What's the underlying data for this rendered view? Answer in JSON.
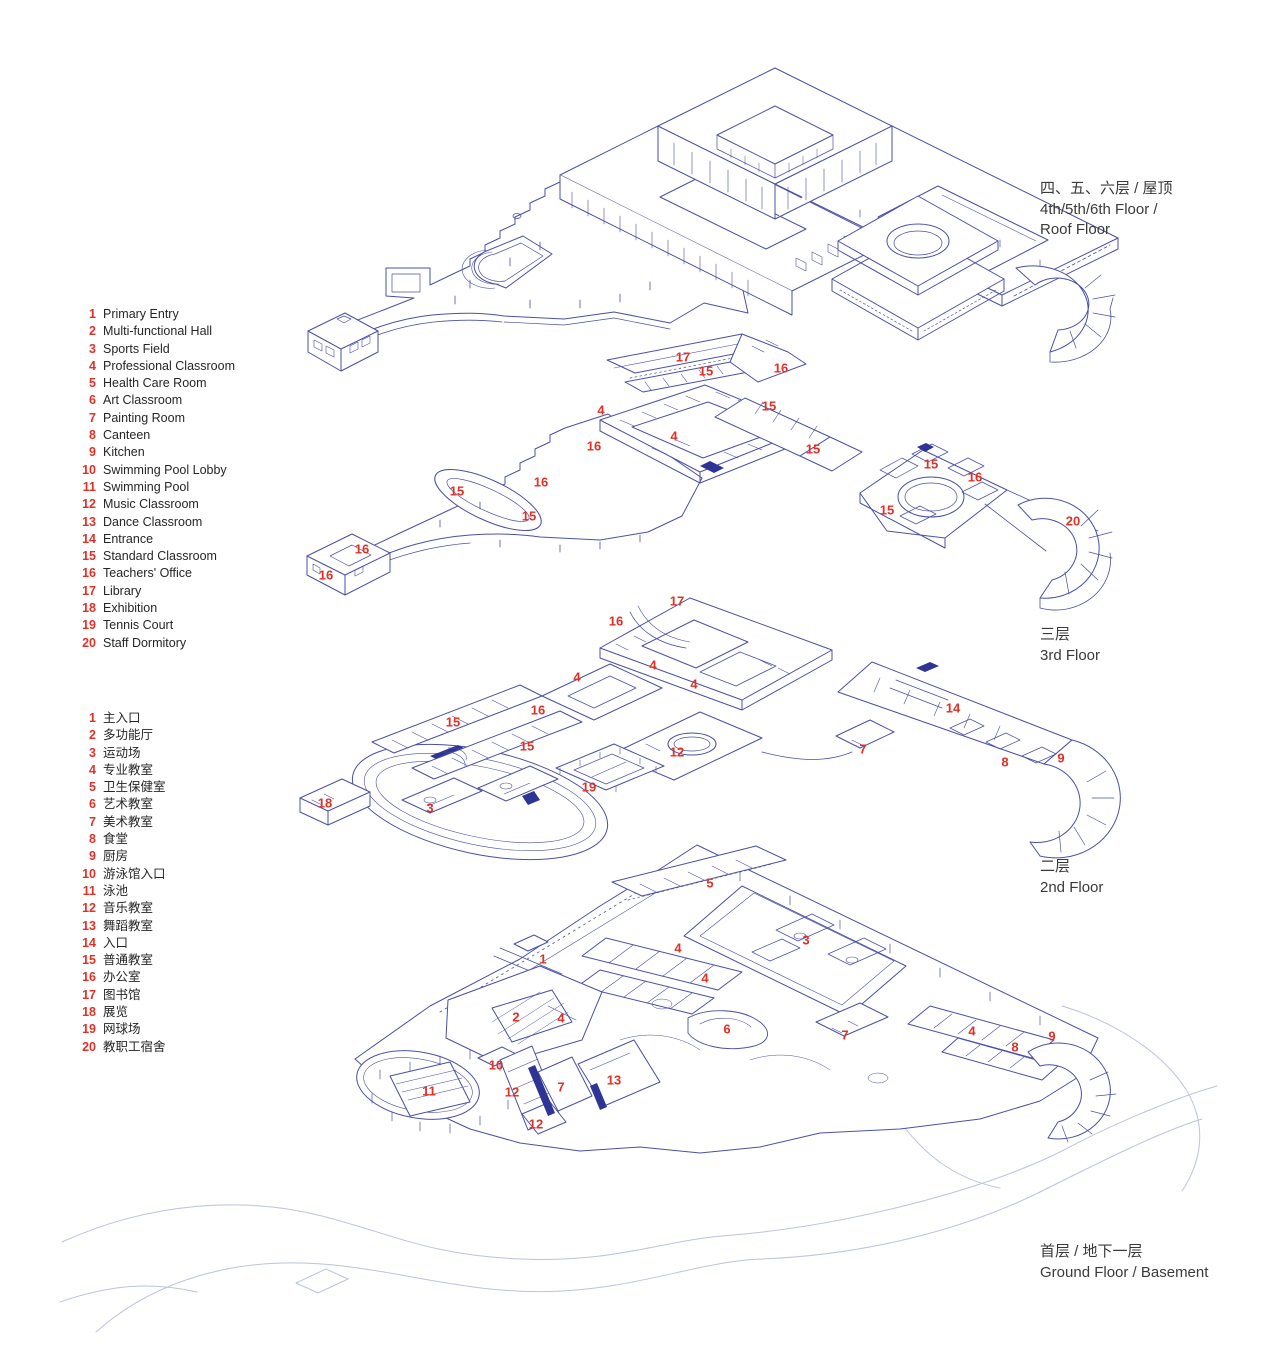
{
  "colors": {
    "ink": "#4a50a5",
    "ink_dark": "#2e3494",
    "site_line": "#bcc4de",
    "red": "#e03127",
    "text": "#262626"
  },
  "legend_en": {
    "items": [
      {
        "num": "1",
        "label": "Primary Entry"
      },
      {
        "num": "2",
        "label": "Multi-functional Hall"
      },
      {
        "num": "3",
        "label": "Sports Field"
      },
      {
        "num": "4",
        "label": "Professional Classroom"
      },
      {
        "num": "5",
        "label": "Health Care Room"
      },
      {
        "num": "6",
        "label": "Art Classroom"
      },
      {
        "num": "7",
        "label": "Painting Room"
      },
      {
        "num": "8",
        "label": "Canteen"
      },
      {
        "num": "9",
        "label": "Kitchen"
      },
      {
        "num": "10",
        "label": "Swimming Pool Lobby"
      },
      {
        "num": "11",
        "label": "Swimming Pool"
      },
      {
        "num": "12",
        "label": "Music Classroom"
      },
      {
        "num": "13",
        "label": "Dance Classroom"
      },
      {
        "num": "14",
        "label": "Entrance"
      },
      {
        "num": "15",
        "label": "Standard Classroom"
      },
      {
        "num": "16",
        "label": "Teachers' Office"
      },
      {
        "num": "17",
        "label": "Library"
      },
      {
        "num": "18",
        "label": "Exhibition"
      },
      {
        "num": "19",
        "label": "Tennis Court"
      },
      {
        "num": "20",
        "label": "Staff Dormitory"
      }
    ]
  },
  "legend_cn": {
    "items": [
      {
        "num": "1",
        "label": "主入口"
      },
      {
        "num": "2",
        "label": "多功能厅"
      },
      {
        "num": "3",
        "label": "运动场"
      },
      {
        "num": "4",
        "label": "专业教室"
      },
      {
        "num": "5",
        "label": "卫生保健室"
      },
      {
        "num": "6",
        "label": "艺术教室"
      },
      {
        "num": "7",
        "label": "美术教室"
      },
      {
        "num": "8",
        "label": "食堂"
      },
      {
        "num": "9",
        "label": "厨房"
      },
      {
        "num": "10",
        "label": "游泳馆入口"
      },
      {
        "num": "11",
        "label": "泳池"
      },
      {
        "num": "12",
        "label": "音乐教室"
      },
      {
        "num": "13",
        "label": "舞蹈教室"
      },
      {
        "num": "14",
        "label": "入口"
      },
      {
        "num": "15",
        "label": "普通教室"
      },
      {
        "num": "16",
        "label": "办公室"
      },
      {
        "num": "17",
        "label": "图书馆"
      },
      {
        "num": "18",
        "label": "展览"
      },
      {
        "num": "19",
        "label": "网球场"
      },
      {
        "num": "20",
        "label": "教职工宿舍"
      }
    ]
  },
  "floor_labels": [
    {
      "id": "roof",
      "cn": "四、五、六层 / 屋顶",
      "en": "4th/5th/6th Floor /\nRoof Floor"
    },
    {
      "id": "f3",
      "cn": "三层",
      "en": "3rd Floor"
    },
    {
      "id": "f2",
      "cn": "二层",
      "en": "2nd Floor"
    },
    {
      "id": "ground",
      "cn": "首层 / 地下一层",
      "en": "Ground Floor / Basement"
    }
  ],
  "markers": [
    {
      "floor": "f3",
      "num": "17",
      "x": 683,
      "y": 357
    },
    {
      "floor": "f3",
      "num": "15",
      "x": 706,
      "y": 371
    },
    {
      "floor": "f3",
      "num": "16",
      "x": 781,
      "y": 368
    },
    {
      "floor": "f3",
      "num": "4",
      "x": 601,
      "y": 410
    },
    {
      "floor": "f3",
      "num": "15",
      "x": 769,
      "y": 406
    },
    {
      "floor": "f3",
      "num": "4",
      "x": 674,
      "y": 436
    },
    {
      "floor": "f3",
      "num": "16",
      "x": 594,
      "y": 446
    },
    {
      "floor": "f3",
      "num": "15",
      "x": 813,
      "y": 449
    },
    {
      "floor": "f3",
      "num": "16",
      "x": 541,
      "y": 482
    },
    {
      "floor": "f3",
      "num": "15",
      "x": 457,
      "y": 491
    },
    {
      "floor": "f3",
      "num": "15",
      "x": 529,
      "y": 516
    },
    {
      "floor": "f3",
      "num": "16",
      "x": 362,
      "y": 549
    },
    {
      "floor": "f3",
      "num": "16",
      "x": 326,
      "y": 575
    },
    {
      "floor": "f3",
      "num": "15",
      "x": 931,
      "y": 464
    },
    {
      "floor": "f3",
      "num": "16",
      "x": 975,
      "y": 477
    },
    {
      "floor": "f3",
      "num": "15",
      "x": 887,
      "y": 510
    },
    {
      "floor": "f3",
      "num": "20",
      "x": 1073,
      "y": 521
    },
    {
      "floor": "f2",
      "num": "17",
      "x": 677,
      "y": 601
    },
    {
      "floor": "f2",
      "num": "16",
      "x": 616,
      "y": 621
    },
    {
      "floor": "f2",
      "num": "4",
      "x": 653,
      "y": 665
    },
    {
      "floor": "f2",
      "num": "4",
      "x": 577,
      "y": 677
    },
    {
      "floor": "f2",
      "num": "4",
      "x": 694,
      "y": 684
    },
    {
      "floor": "f2",
      "num": "16",
      "x": 538,
      "y": 710
    },
    {
      "floor": "f2",
      "num": "15",
      "x": 453,
      "y": 722
    },
    {
      "floor": "f2",
      "num": "15",
      "x": 527,
      "y": 746
    },
    {
      "floor": "f2",
      "num": "12",
      "x": 677,
      "y": 752
    },
    {
      "floor": "f2",
      "num": "19",
      "x": 589,
      "y": 787
    },
    {
      "floor": "f2",
      "num": "18",
      "x": 325,
      "y": 803
    },
    {
      "floor": "f2",
      "num": "3",
      "x": 430,
      "y": 808
    },
    {
      "floor": "f2",
      "num": "14",
      "x": 953,
      "y": 708
    },
    {
      "floor": "f2",
      "num": "7",
      "x": 863,
      "y": 749
    },
    {
      "floor": "f2",
      "num": "8",
      "x": 1005,
      "y": 762
    },
    {
      "floor": "f2",
      "num": "9",
      "x": 1061,
      "y": 758
    },
    {
      "floor": "ground",
      "num": "5",
      "x": 710,
      "y": 883
    },
    {
      "floor": "ground",
      "num": "3",
      "x": 806,
      "y": 940
    },
    {
      "floor": "ground",
      "num": "4",
      "x": 678,
      "y": 948
    },
    {
      "floor": "ground",
      "num": "1",
      "x": 543,
      "y": 959
    },
    {
      "floor": "ground",
      "num": "4",
      "x": 705,
      "y": 978
    },
    {
      "floor": "ground",
      "num": "2",
      "x": 516,
      "y": 1017
    },
    {
      "floor": "ground",
      "num": "4",
      "x": 561,
      "y": 1018
    },
    {
      "floor": "ground",
      "num": "6",
      "x": 727,
      "y": 1029
    },
    {
      "floor": "ground",
      "num": "7",
      "x": 845,
      "y": 1035
    },
    {
      "floor": "ground",
      "num": "4",
      "x": 972,
      "y": 1031
    },
    {
      "floor": "ground",
      "num": "8",
      "x": 1015,
      "y": 1047
    },
    {
      "floor": "ground",
      "num": "9",
      "x": 1052,
      "y": 1036
    },
    {
      "floor": "ground",
      "num": "10",
      "x": 496,
      "y": 1065
    },
    {
      "floor": "ground",
      "num": "11",
      "x": 429,
      "y": 1091
    },
    {
      "floor": "ground",
      "num": "12",
      "x": 512,
      "y": 1092
    },
    {
      "floor": "ground",
      "num": "7",
      "x": 561,
      "y": 1087
    },
    {
      "floor": "ground",
      "num": "13",
      "x": 614,
      "y": 1080
    },
    {
      "floor": "ground",
      "num": "12",
      "x": 536,
      "y": 1124
    }
  ]
}
